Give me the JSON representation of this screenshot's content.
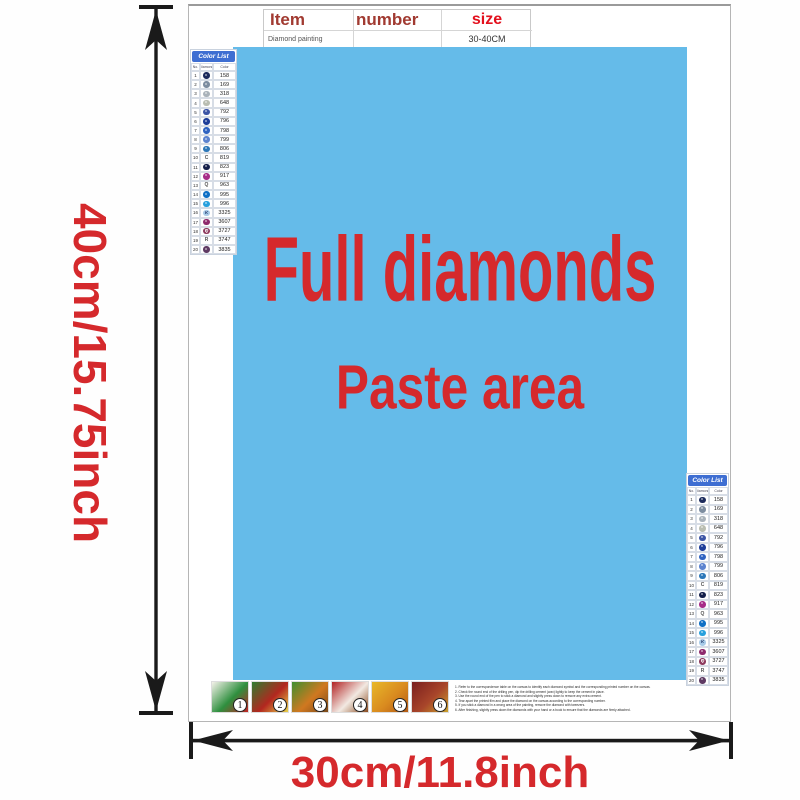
{
  "spec_table": {
    "headers": [
      "Item",
      "number",
      "size"
    ],
    "row": [
      "Diamond painting",
      "",
      "30-40CM"
    ],
    "header_color": "#a13a31",
    "size_color": "#e3101d"
  },
  "paste_area": {
    "line1": "Full diamonds",
    "line2": "Paste area",
    "bg": "#65bbe9",
    "text_color": "#d5292c"
  },
  "dimensions": {
    "height_label": "40cm/15.75inch",
    "width_label": "30cm/11.8inch",
    "label_color": "#d5292c",
    "arrow_color": "#1a1a1a"
  },
  "color_list": {
    "title": "Color List",
    "header_bg": "#3e6ed2",
    "columns": [
      "No.",
      "Diamond",
      "Color"
    ],
    "rows": [
      {
        "no": "1",
        "sym": "",
        "code": "158",
        "circle": "#1b2a5c",
        "light": false
      },
      {
        "no": "2",
        "sym": "",
        "code": "169",
        "circle": "#7d8da0",
        "light": false
      },
      {
        "no": "3",
        "sym": "",
        "code": "318",
        "circle": "#a9b2ba",
        "light": false
      },
      {
        "no": "4",
        "sym": "",
        "code": "648",
        "circle": "#b9bdb1",
        "light": false
      },
      {
        "no": "5",
        "sym": "",
        "code": "792",
        "circle": "#3c55a5",
        "light": false
      },
      {
        "no": "6",
        "sym": "",
        "code": "796",
        "circle": "#1d3d99",
        "light": false
      },
      {
        "no": "7",
        "sym": "",
        "code": "798",
        "circle": "#2f63c1",
        "light": false
      },
      {
        "no": "8",
        "sym": "",
        "code": "799",
        "circle": "#5c83cf",
        "light": false
      },
      {
        "no": "9",
        "sym": "",
        "code": "806",
        "circle": "#2c77b8",
        "light": false
      },
      {
        "no": "10",
        "sym": "C",
        "code": "819",
        "circle": "",
        "light": false
      },
      {
        "no": "11",
        "sym": "",
        "code": "823",
        "circle": "#141f4a",
        "light": false
      },
      {
        "no": "12",
        "sym": "",
        "code": "917",
        "circle": "#a62c88",
        "light": false
      },
      {
        "no": "13",
        "sym": "Q",
        "code": "963",
        "circle": "",
        "light": false
      },
      {
        "no": "14",
        "sym": "",
        "code": "995",
        "circle": "#0f6fc5",
        "light": false
      },
      {
        "no": "15",
        "sym": "",
        "code": "996",
        "circle": "#27a0dd",
        "light": false
      },
      {
        "no": "16",
        "sym": "K",
        "code": "3325",
        "circle": "#a8cbe8",
        "light": true
      },
      {
        "no": "17",
        "sym": "",
        "code": "3607",
        "circle": "#8f2a6d",
        "light": false
      },
      {
        "no": "18",
        "sym": "Q",
        "code": "3727",
        "circle": "#8d3a5e",
        "light": false
      },
      {
        "no": "19",
        "sym": "R",
        "code": "3747",
        "circle": "",
        "light": false
      },
      {
        "no": "20",
        "sym": "",
        "code": "3835",
        "circle": "#5f3a63",
        "light": false
      }
    ]
  },
  "instructions": {
    "thumbs": [
      {
        "num": "1",
        "colors": [
          "#f5f2ea",
          "#2e8f3e",
          "#c22323"
        ]
      },
      {
        "num": "2",
        "colors": [
          "#2f7d2f",
          "#b3271f",
          "#e8d24a"
        ]
      },
      {
        "num": "3",
        "colors": [
          "#3f8f2f",
          "#d07820",
          "#7a4a1a"
        ]
      },
      {
        "num": "4",
        "colors": [
          "#b22323",
          "#f2e9e2",
          "#8a4a1e"
        ]
      },
      {
        "num": "5",
        "colors": [
          "#e8b82a",
          "#d98a1f",
          "#b35a14"
        ]
      },
      {
        "num": "6",
        "colors": [
          "#7a1f1e",
          "#a8452a",
          "#caa12c"
        ]
      }
    ],
    "lines": [
      "1. Refer to the correspondence table on the canvas to identify each diamond symbol and the corresponding printed number on the canvas.",
      "2. Check the round end of the drilling pen, dip the drilling cement (wax) lightly to keep the cement in place.",
      "3. Use the round end of the pen to stick a diamond and slightly press down to remove any extra cement.",
      "4. Tear apart the printed film and place the diamond on the canvas according to the corresponding number.",
      "5. If you stick a diamond in a wrong area of the painting, remove the diamond with tweezers.",
      "6. After finishing, slightly press down the diamonds with your hand or a book to ensure that the diamonds are firmly attached."
    ]
  }
}
